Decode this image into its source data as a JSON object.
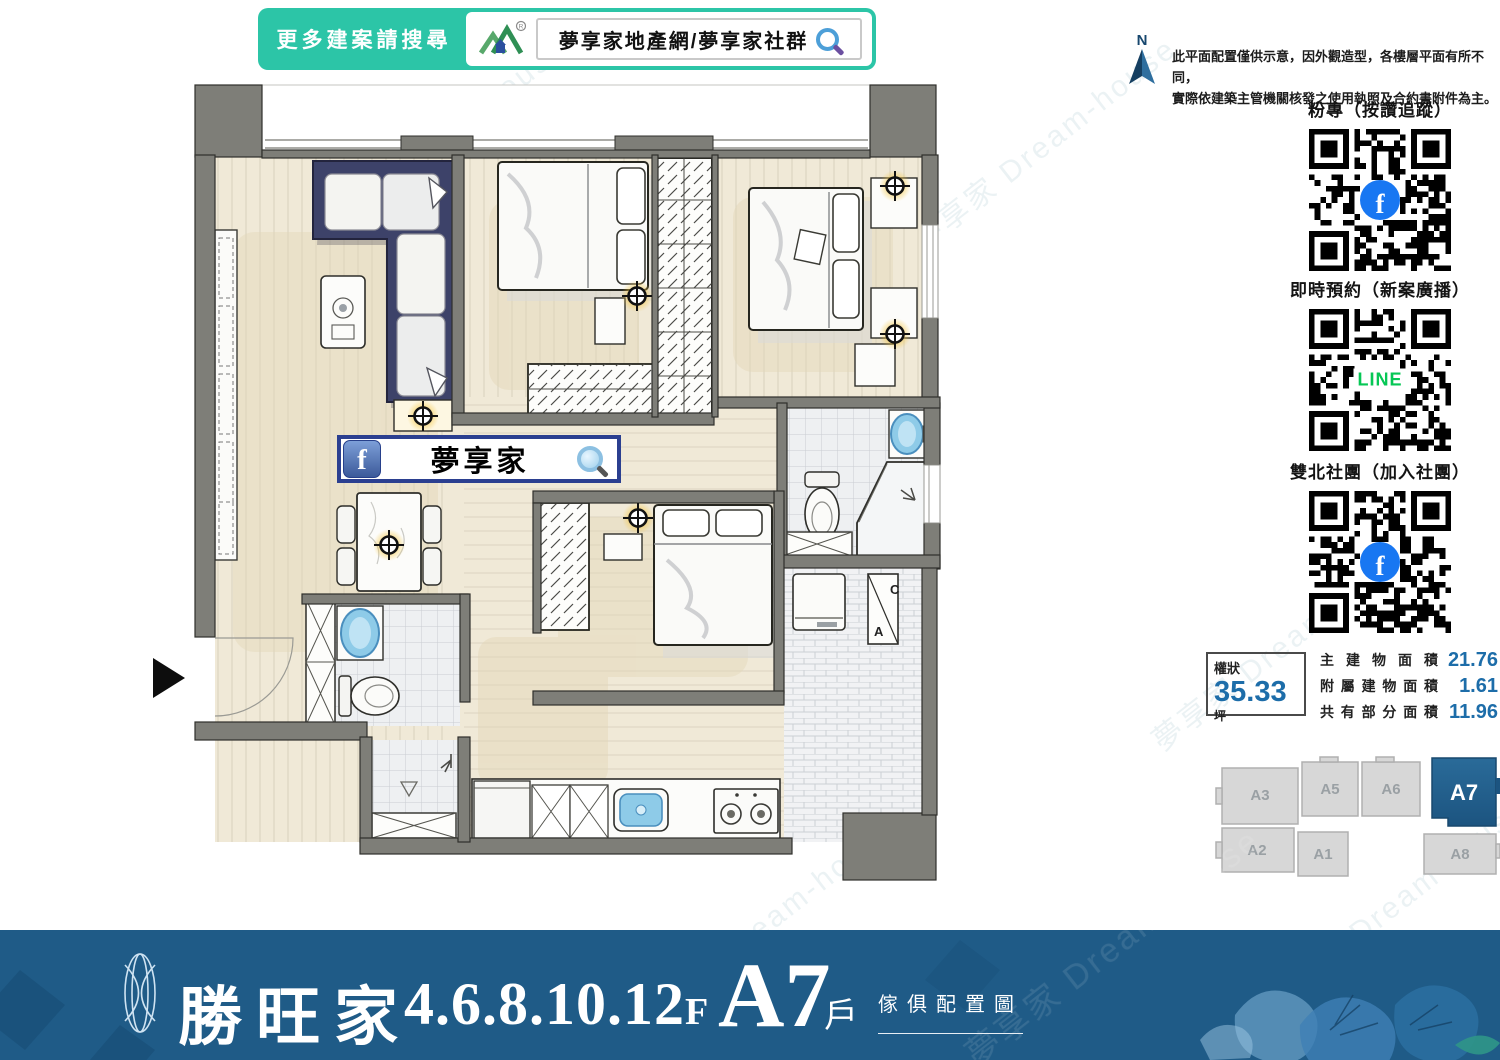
{
  "top_banner": {
    "prompt": "更多建案請搜尋",
    "site_text": "夢享家地產網/夢享家社群"
  },
  "north": {
    "label": "N"
  },
  "disclaimer": {
    "line1": "此平面配置僅供示意，因外觀造型，各樓層平面有所不同，",
    "line2": "實際依建築主管機關核發之使用執照及合約書附件為主。"
  },
  "qr_sections": [
    {
      "title": "粉專（按讚追蹤）",
      "center_type": "facebook",
      "center_label": "f"
    },
    {
      "title": "即時預約（新案廣播）",
      "center_type": "line",
      "center_label": "LINE"
    },
    {
      "title": "雙北社團（加入社團）",
      "center_type": "facebook",
      "center_label": "f"
    }
  ],
  "area_info": {
    "deed_label": "權狀",
    "deed_value": "35.33",
    "unit": "坪",
    "rows": [
      {
        "label": "主建物面積",
        "value": "21.76",
        "unit": "坪"
      },
      {
        "label": "附屬建物面積",
        "value": "1.61",
        "unit": "坪"
      },
      {
        "label": "共有部分面積",
        "value": "11.96",
        "unit": "坪"
      }
    ]
  },
  "floor_key": {
    "units": [
      {
        "id": "A3"
      },
      {
        "id": "A5"
      },
      {
        "id": "A6"
      },
      {
        "id": "A7"
      },
      {
        "id": "A2"
      },
      {
        "id": "A1"
      },
      {
        "id": "A8"
      }
    ],
    "highlighted": "A7"
  },
  "plan": {
    "fb_banner_text": "夢享家",
    "fb_glyph": "f",
    "ac_letter_top": "C",
    "ac_letter_bottom": "A"
  },
  "footer": {
    "brand": "勝旺家",
    "floors": "4.6.8.10.12",
    "floors_suffix": "F",
    "unit": "A7",
    "unit_suffix": "戶",
    "subtitle": "傢俱配置圖"
  },
  "watermark": "夢享家 Dream-house",
  "colors": {
    "teal": "#2cc5a7",
    "footer_blue": "#1f5b87",
    "value_blue": "#1d6da9",
    "unit_highlight": "#1f5e8d",
    "line_green": "#06c755",
    "facebook_blue": "#1877f2"
  }
}
